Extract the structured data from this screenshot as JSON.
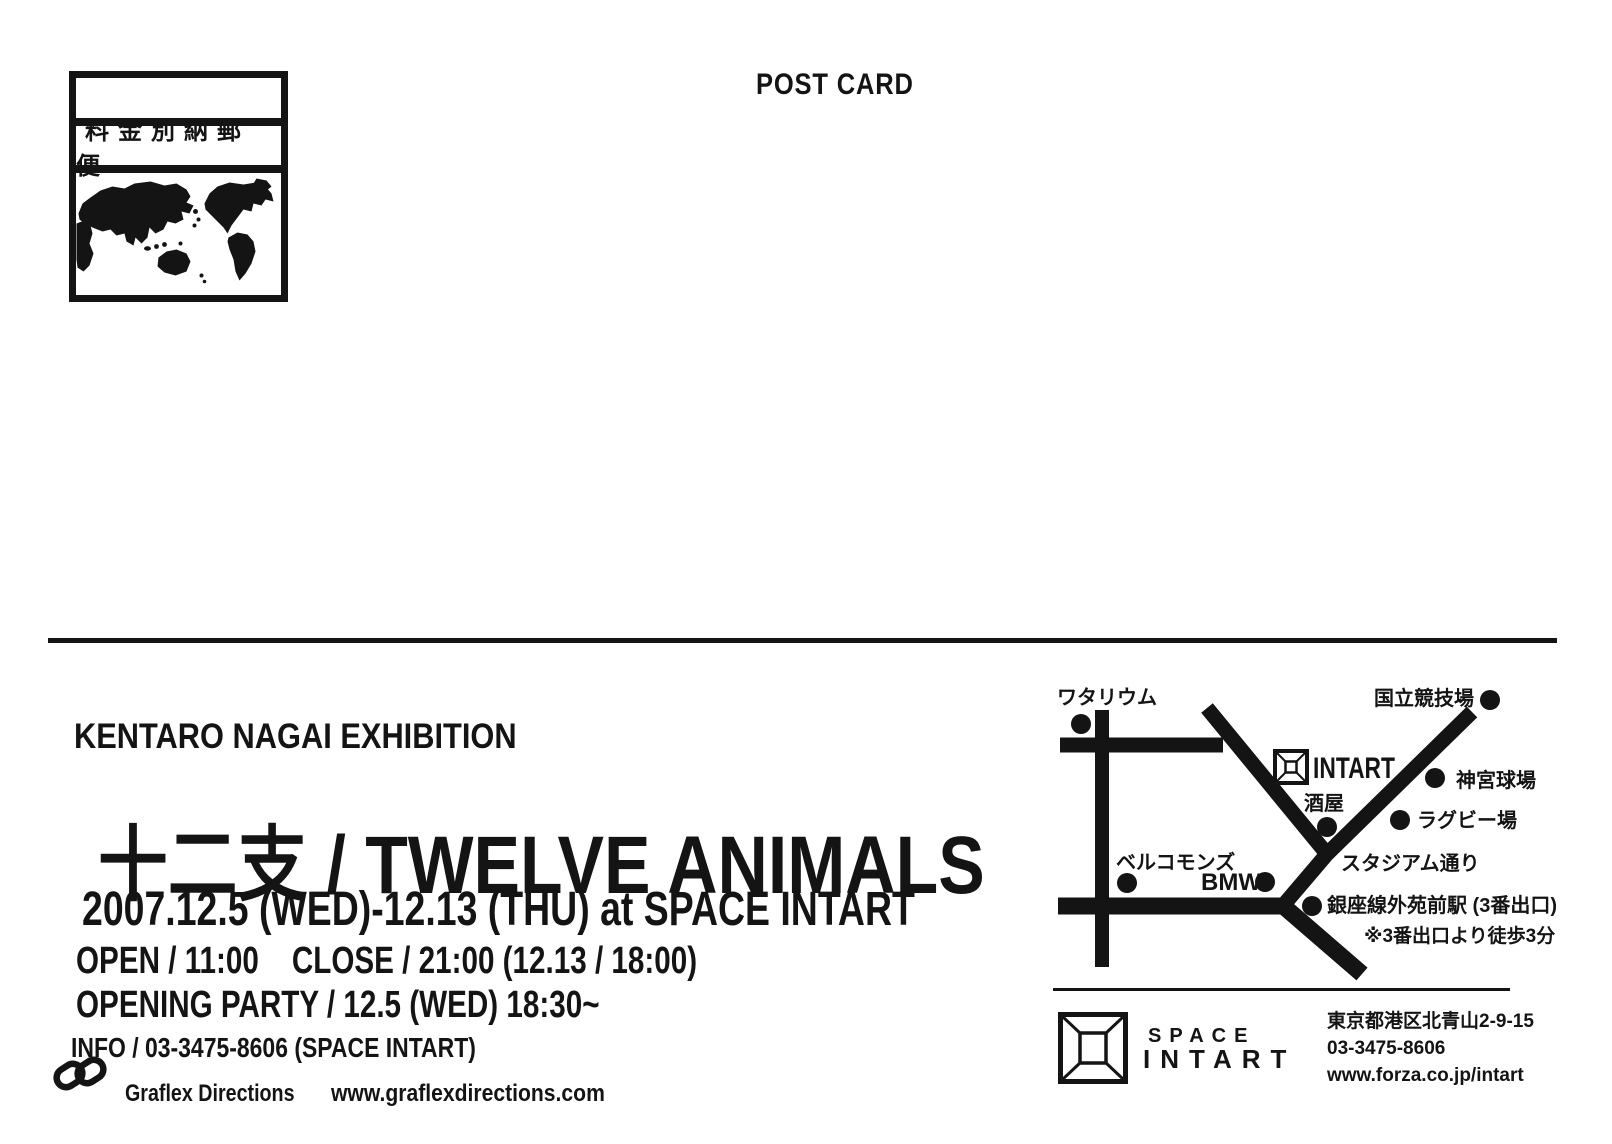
{
  "postcard": {
    "header": {
      "post_card_label": "POST CARD"
    },
    "postage_mark": {
      "label": "料金別納郵便"
    },
    "exhibition": {
      "artist_line": "KENTARO NAGAI EXHIBITION",
      "title": "十二支 / TWELVE ANIMALS",
      "date_line": "2007.12.5 (WED)-12.13 (THU) at SPACE INTART",
      "hours_line": "OPEN / 11:00    CLOSE / 21:00 (12.13 / 18:00)",
      "party_line": "OPENING PARTY / 12.5 (WED) 18:30~",
      "info_line": "INFO / 03-3475-8606 (SPACE INTART)"
    },
    "credit": {
      "name": "Graflex Directions",
      "website": "www.graflexdirections.com"
    },
    "map": {
      "labels": {
        "watarium": "ワタリウム",
        "national_stadium": "国立競技場",
        "intart": "INTART",
        "sake_shop": "酒屋",
        "jingu_stadium": "神宮球場",
        "rugby_field": "ラグビー場",
        "bell_commons": "ベルコモンズ",
        "bmw": "BMW",
        "stadium_street": "スタジアム通り",
        "station": "銀座線外苑前駅 (3番出口)",
        "walk_note": "※3番出口より徒歩3分"
      }
    },
    "venue": {
      "logo_line1": "SPACE",
      "logo_line2": "INTART",
      "address": "東京都港区北青山2-9-15",
      "tel": "03-3475-8606",
      "website": "www.forza.co.jp/intart"
    },
    "colors": {
      "ink": "#141414",
      "paper": "#ffffff"
    }
  }
}
